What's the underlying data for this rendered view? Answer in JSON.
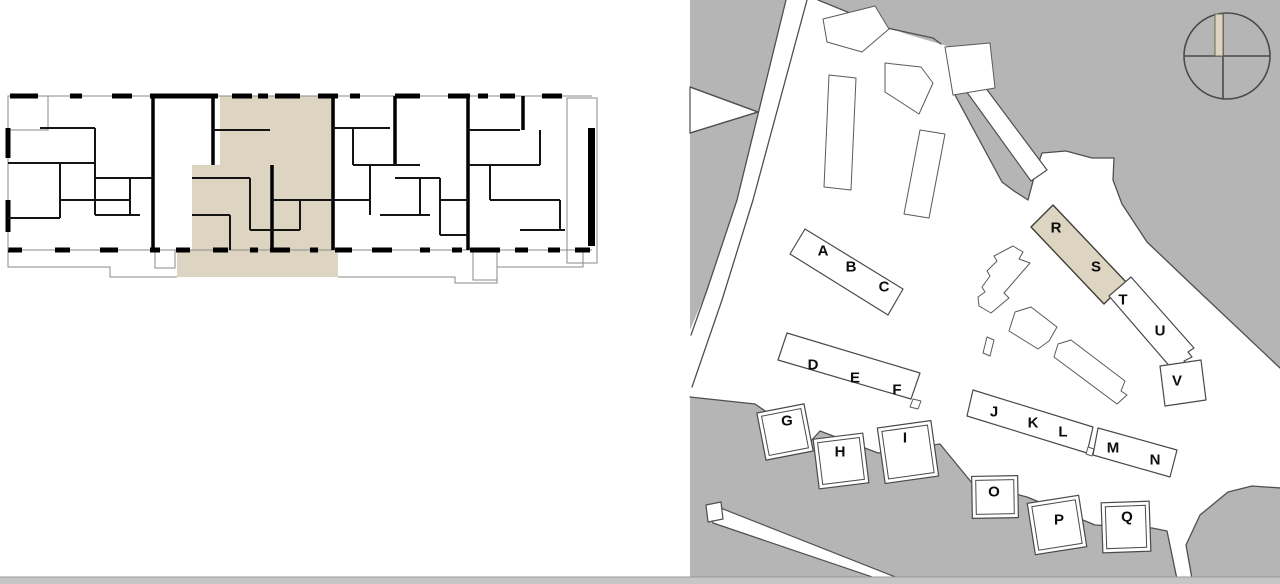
{
  "app": {
    "title": "Residential development plan viewer",
    "views": {
      "left": "apartment floor plan",
      "right": "site plan"
    }
  },
  "colors": {
    "highlight_beige": "#ddd5c2",
    "land_gray": "#b5b5b5",
    "outline_dark": "#4f4f4f",
    "wall_black": "#000000",
    "bottom_bar": "#c6c6c6"
  },
  "floor_plan": {
    "description": "detailed floor plan with one unit highlighted in beige",
    "highlight_color": "#ddd5c2"
  },
  "site_plan": {
    "highlighted_building": "R-S block",
    "compass_icon": "circle-cross-north-needle",
    "buildings": [
      {
        "label": "A",
        "x": 823,
        "y": 251,
        "highlighted": false
      },
      {
        "label": "B",
        "x": 851,
        "y": 267,
        "highlighted": false
      },
      {
        "label": "C",
        "x": 884,
        "y": 287,
        "highlighted": false
      },
      {
        "label": "D",
        "x": 813,
        "y": 365,
        "highlighted": false
      },
      {
        "label": "E",
        "x": 855,
        "y": 378,
        "highlighted": false
      },
      {
        "label": "F",
        "x": 897,
        "y": 390,
        "highlighted": false
      },
      {
        "label": "G",
        "x": 787,
        "y": 421,
        "highlighted": false
      },
      {
        "label": "H",
        "x": 840,
        "y": 452,
        "highlighted": false
      },
      {
        "label": "I",
        "x": 905,
        "y": 438,
        "highlighted": false
      },
      {
        "label": "J",
        "x": 994,
        "y": 412,
        "highlighted": false
      },
      {
        "label": "K",
        "x": 1033,
        "y": 423,
        "highlighted": false
      },
      {
        "label": "L",
        "x": 1063,
        "y": 432,
        "highlighted": false
      },
      {
        "label": "M",
        "x": 1113,
        "y": 448,
        "highlighted": false
      },
      {
        "label": "N",
        "x": 1155,
        "y": 460,
        "highlighted": false
      },
      {
        "label": "O",
        "x": 994,
        "y": 492,
        "highlighted": false
      },
      {
        "label": "P",
        "x": 1059,
        "y": 520,
        "highlighted": false
      },
      {
        "label": "Q",
        "x": 1127,
        "y": 517,
        "highlighted": false
      },
      {
        "label": "R",
        "x": 1056,
        "y": 228,
        "highlighted": true
      },
      {
        "label": "S",
        "x": 1096,
        "y": 267,
        "highlighted": true
      },
      {
        "label": "T",
        "x": 1123,
        "y": 300,
        "highlighted": false
      },
      {
        "label": "U",
        "x": 1160,
        "y": 331,
        "highlighted": false
      },
      {
        "label": "V",
        "x": 1177,
        "y": 381,
        "highlighted": false
      }
    ]
  }
}
